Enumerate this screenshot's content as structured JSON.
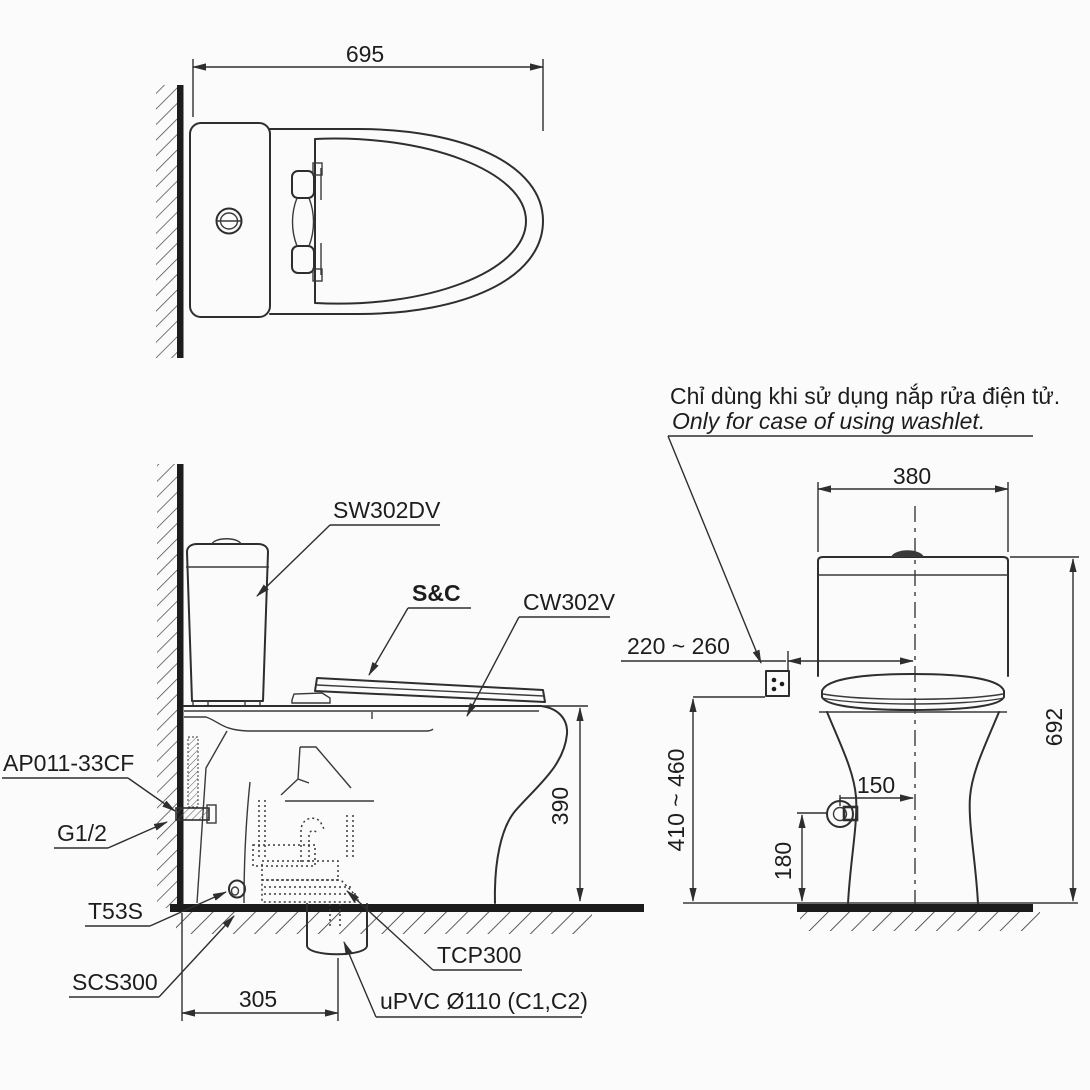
{
  "note": {
    "line1": "Chỉ dùng khi sử dụng nắp rửa điện tử.",
    "line2": "Only for case of using washlet."
  },
  "parts": {
    "cistern": "SW302DV",
    "seat_cover": "S&C",
    "bowl": "CW302V",
    "supply_valve": "AP011-33CF",
    "thread": "G1/2",
    "seal": "T53S",
    "flange": "SCS300",
    "trap": "TCP300",
    "drain_pipe": "uPVC Ø110 (C1,C2)"
  },
  "dims": {
    "top_width": "695",
    "side_height": "390",
    "side_outlet_offset": "305",
    "front_width": "380",
    "outlet_offset": "220 ~ 260",
    "outlet_height": "410 ~ 460",
    "valve_offset": "150",
    "valve_height": "180",
    "front_height": "692"
  },
  "colors": {
    "background": "#fbfbfb",
    "line": "#2e2e2e"
  }
}
